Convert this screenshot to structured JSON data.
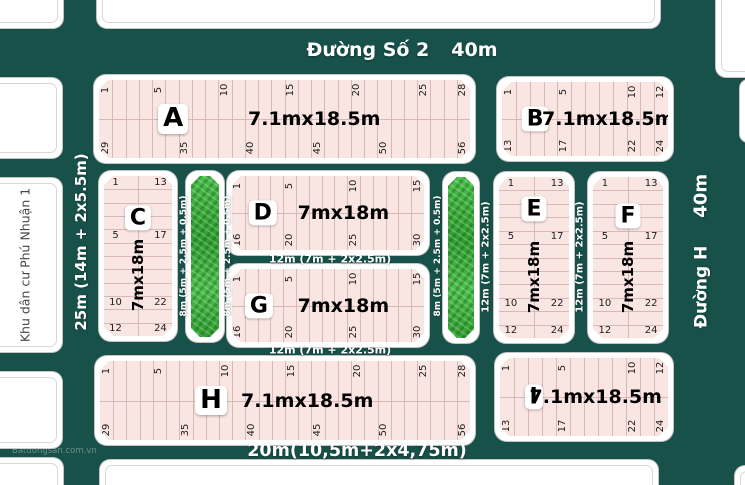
{
  "colors": {
    "road_bg": "#18514a",
    "parcel_fill": "#f9e6e3",
    "parcel_line": "#d9b9b7",
    "green_strip": "#38b038",
    "neighbor_fill": "#ffffff",
    "road_text": "#ffffff",
    "label_text": "#000000"
  },
  "roads": {
    "top": {
      "name": "Đường Số 2",
      "width": "40m"
    },
    "right": {
      "name": "Đường H",
      "width": "40m"
    },
    "left": {
      "label": "25m (14m + 2x5.5m)"
    },
    "bottom": {
      "label": "20m(10,5m+2x4,75m)"
    },
    "labels": {
      "w12": "12m (7m + 2x2.5m)",
      "w8": "8m (5m + 2.5m + 0.5m)"
    }
  },
  "neighborhood": {
    "label": "Khu dân cư Phú Nhuận 1"
  },
  "watermark": {
    "text": "Batdongsan.com.vn"
  },
  "blocks": [
    {
      "id": "A",
      "size_label": "7.1mx18.5m",
      "orientation": "h",
      "rows": [
        {
          "start": 1,
          "count": 28,
          "labels": [
            "1",
            "5",
            "10",
            "15",
            "20",
            "25",
            "28"
          ]
        },
        {
          "start": 29,
          "count": 28,
          "labels": [
            "29",
            "35",
            "40",
            "45",
            "50",
            "56"
          ]
        }
      ]
    },
    {
      "id": "B",
      "size_label": "7.1mx18.5m",
      "orientation": "h",
      "rows": [
        {
          "start": 1,
          "count": 12,
          "labels": [
            "1",
            "5",
            "10",
            "12"
          ]
        },
        {
          "start": 13,
          "count": 12,
          "labels": [
            "13",
            "17",
            "22",
            "24"
          ]
        }
      ]
    },
    {
      "id": "C",
      "size_label": "7mx18m",
      "orientation": "v",
      "rows": [
        {
          "start": 1,
          "count": 12,
          "labels": [
            "1",
            "5",
            "10",
            "12"
          ]
        },
        {
          "start": 13,
          "count": 12,
          "labels": [
            "13",
            "17",
            "22",
            "24"
          ]
        }
      ]
    },
    {
      "id": "D",
      "size_label": "7mx18m",
      "orientation": "h",
      "rows": [
        {
          "start": 1,
          "count": 15,
          "labels": [
            "1",
            "5",
            "10",
            "15"
          ]
        },
        {
          "start": 16,
          "count": 15,
          "labels": [
            "16",
            "20",
            "25",
            "30"
          ]
        }
      ]
    },
    {
      "id": "E",
      "size_label": "7mx18m",
      "orientation": "v",
      "rows": [
        {
          "start": 1,
          "count": 12,
          "labels": [
            "1",
            "5",
            "10",
            "12"
          ]
        },
        {
          "start": 13,
          "count": 12,
          "labels": [
            "13",
            "17",
            "22",
            "24"
          ]
        }
      ]
    },
    {
      "id": "F",
      "size_label": "7mx18m",
      "orientation": "v",
      "rows": [
        {
          "start": 1,
          "count": 12,
          "labels": [
            "1",
            "5",
            "10",
            "12"
          ]
        },
        {
          "start": 13,
          "count": 12,
          "labels": [
            "13",
            "17",
            "22",
            "24"
          ]
        }
      ]
    },
    {
      "id": "G",
      "size_label": "7mx18m",
      "orientation": "h",
      "rows": [
        {
          "start": 1,
          "count": 15,
          "labels": [
            "1",
            "5",
            "10",
            "15"
          ]
        },
        {
          "start": 16,
          "count": 15,
          "labels": [
            "16",
            "20",
            "25",
            "30"
          ]
        }
      ]
    },
    {
      "id": "H",
      "size_label": "7.1mx18.5m",
      "orientation": "h",
      "rows": [
        {
          "start": 1,
          "count": 28,
          "labels": [
            "1",
            "5",
            "10",
            "15",
            "20",
            "25",
            "28"
          ]
        },
        {
          "start": 29,
          "count": 28,
          "labels": [
            "29",
            "35",
            "40",
            "45",
            "50",
            "56"
          ]
        }
      ]
    },
    {
      "id": "I",
      "size_label": "7.1mx18.5m",
      "orientation": "h",
      "rows": [
        {
          "start": 1,
          "count": 12,
          "labels": [
            "1",
            "5",
            "10",
            "12"
          ]
        },
        {
          "start": 13,
          "count": 12,
          "labels": [
            "13",
            "17",
            "22",
            "24"
          ]
        }
      ]
    }
  ]
}
